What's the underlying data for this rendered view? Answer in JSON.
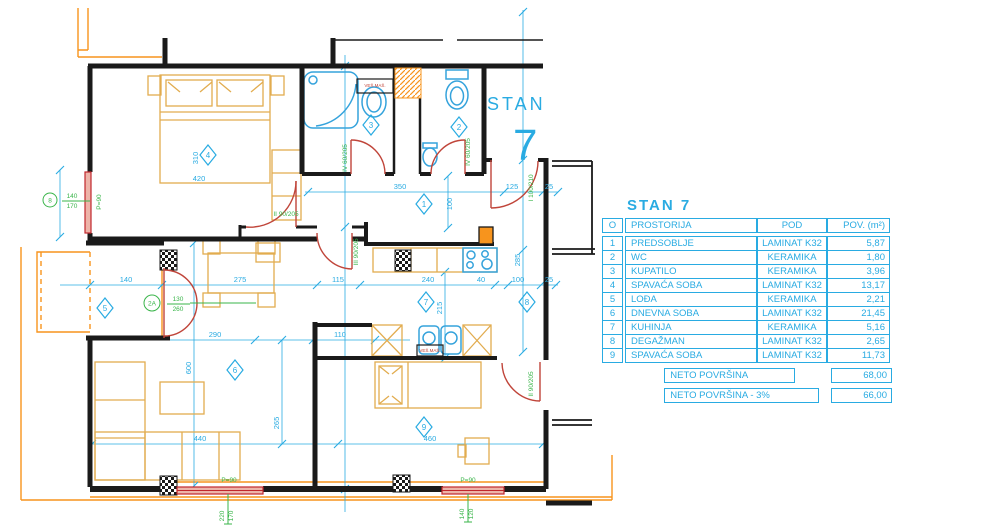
{
  "plan_title": {
    "word": "STAN",
    "number": "7"
  },
  "table": {
    "title": "STAN 7",
    "headers": [
      "O",
      "PROSTORIJA",
      "POD",
      "POV. (m²)"
    ],
    "rows": [
      [
        "1",
        "PREDSOBLJE",
        "LAMINAT K32",
        "5,87"
      ],
      [
        "2",
        "WC",
        "KERAMIKA",
        "1,80"
      ],
      [
        "3",
        "KUPATILO",
        "KERAMIKA",
        "3,96"
      ],
      [
        "4",
        "SPAVAĆA SOBA",
        "LAMINAT K32",
        "13,17"
      ],
      [
        "5",
        "LOĐA",
        "KERAMIKA",
        "2,21"
      ],
      [
        "6",
        "DNEVNA SOBA",
        "LAMINAT K32",
        "21,45"
      ],
      [
        "7",
        "KUHINJA",
        "KERAMIKA",
        "5,16"
      ],
      [
        "8",
        "DEGAŽMAN",
        "LAMINAT K32",
        "2,65"
      ],
      [
        "9",
        "SPAVAĆA SOBA",
        "LAMINAT K32",
        "11,73"
      ]
    ],
    "summary": [
      {
        "label": "NETO POVRŠINA",
        "value": "68,00"
      },
      {
        "label": "NETO POVRŠINA - 3%",
        "value": "66,00"
      }
    ]
  },
  "room_markers": [
    "1",
    "2",
    "3",
    "4",
    "5",
    "6",
    "7",
    "8",
    "9"
  ],
  "dims": [
    "350",
    "125",
    "25",
    "100",
    "115",
    "240",
    "40",
    "100",
    "25",
    "140",
    "275",
    "290",
    "110",
    "440",
    "460",
    "600",
    "265",
    "215",
    "285",
    "310",
    "420"
  ],
  "door_labels": [
    "IV 60/205",
    "IV 60/205",
    "II 90/205",
    "III 90/205",
    "I 100/210",
    "II 90/205"
  ],
  "openings": {
    "left_mark": "8",
    "left_w": "140",
    "left_h": "170",
    "left_parapet": "P=90",
    "balcony_mark": "2A",
    "balcony_w": "130",
    "balcony_h": "260",
    "win1_parapet": "P=90",
    "win1_w": "220",
    "win1_h": "170",
    "win2_parapet": "P=90",
    "win2_w": "140",
    "win2_h": "120"
  },
  "appliance_labels": {
    "washer": "VEŠ.MAŠ.",
    "washer2": "VEŠ.MAŠ."
  },
  "colors": {
    "cyan": "#29ABE2",
    "yellow": "#E2AC4F",
    "orange": "#F7941D",
    "red": "#C0453A",
    "green": "#3AB54A",
    "wall": "#1a1a1a"
  }
}
